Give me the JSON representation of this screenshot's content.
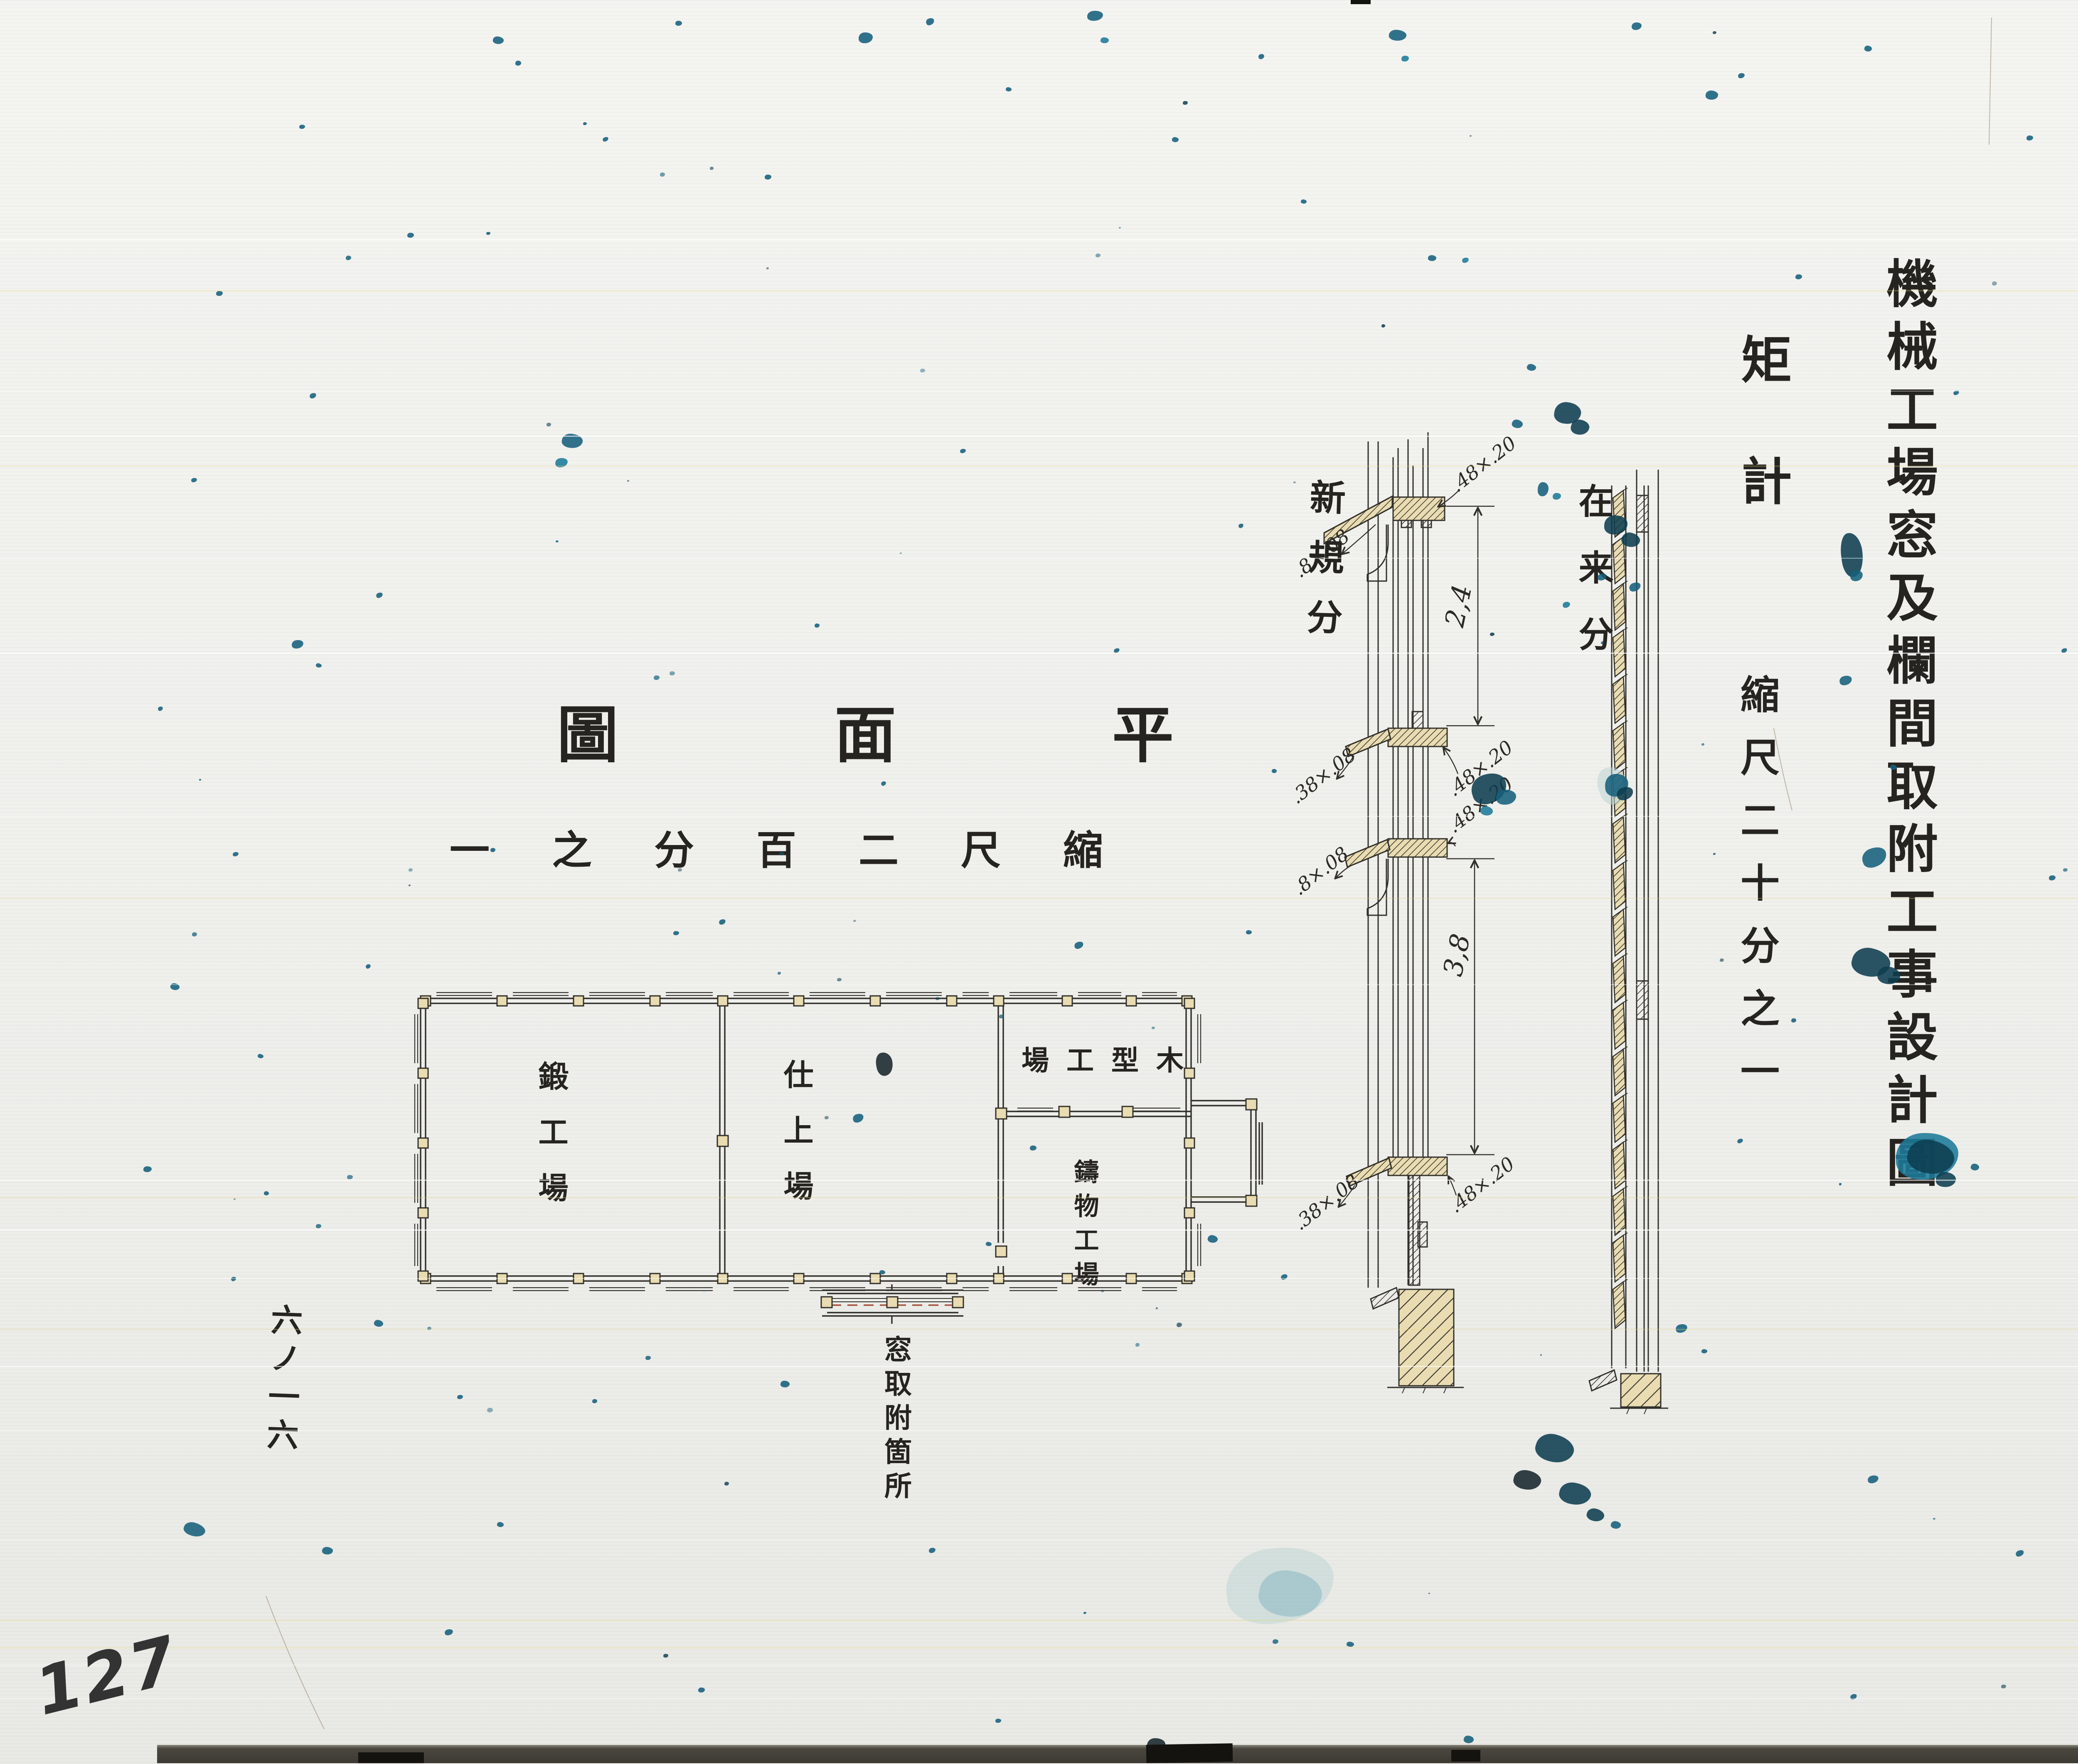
{
  "title_block": {
    "main_title": "機械工場窓及欄間取附工事設計圖",
    "detail_label": "矩計",
    "detail_scale": "縮尺二十分之一"
  },
  "plan": {
    "title": "圖面平",
    "scale": "一之分百二尺縮",
    "rooms": {
      "forge": "鍛工場",
      "finishing": "仕上場",
      "wood_pattern": "場工型木",
      "casting": "鑄物工場"
    },
    "note": "窓取附箇所"
  },
  "sections": {
    "new": {
      "label": "新規分",
      "dim_upper": "2,4",
      "dim_lower": "3,8",
      "head_left": ".8×.08",
      "head_right": ".48×.20",
      "rail_left": ".38×.08",
      "rail_right": ".48×.20",
      "rail2_left": ".8×.08",
      "rail2_right": ".48×.20",
      "sill_left": ".38×.08",
      "sill_right": ".48×.20"
    },
    "existing": {
      "label": "在来分"
    }
  },
  "margin_notes": {
    "folio": "六ノ一六",
    "page_number": "127"
  },
  "colors": {
    "paper": "#e9dcb2",
    "ink": "#32302a",
    "stain_teal": "#16607c",
    "stain_navy": "#0e3d50",
    "accent_red": "#a85038"
  }
}
